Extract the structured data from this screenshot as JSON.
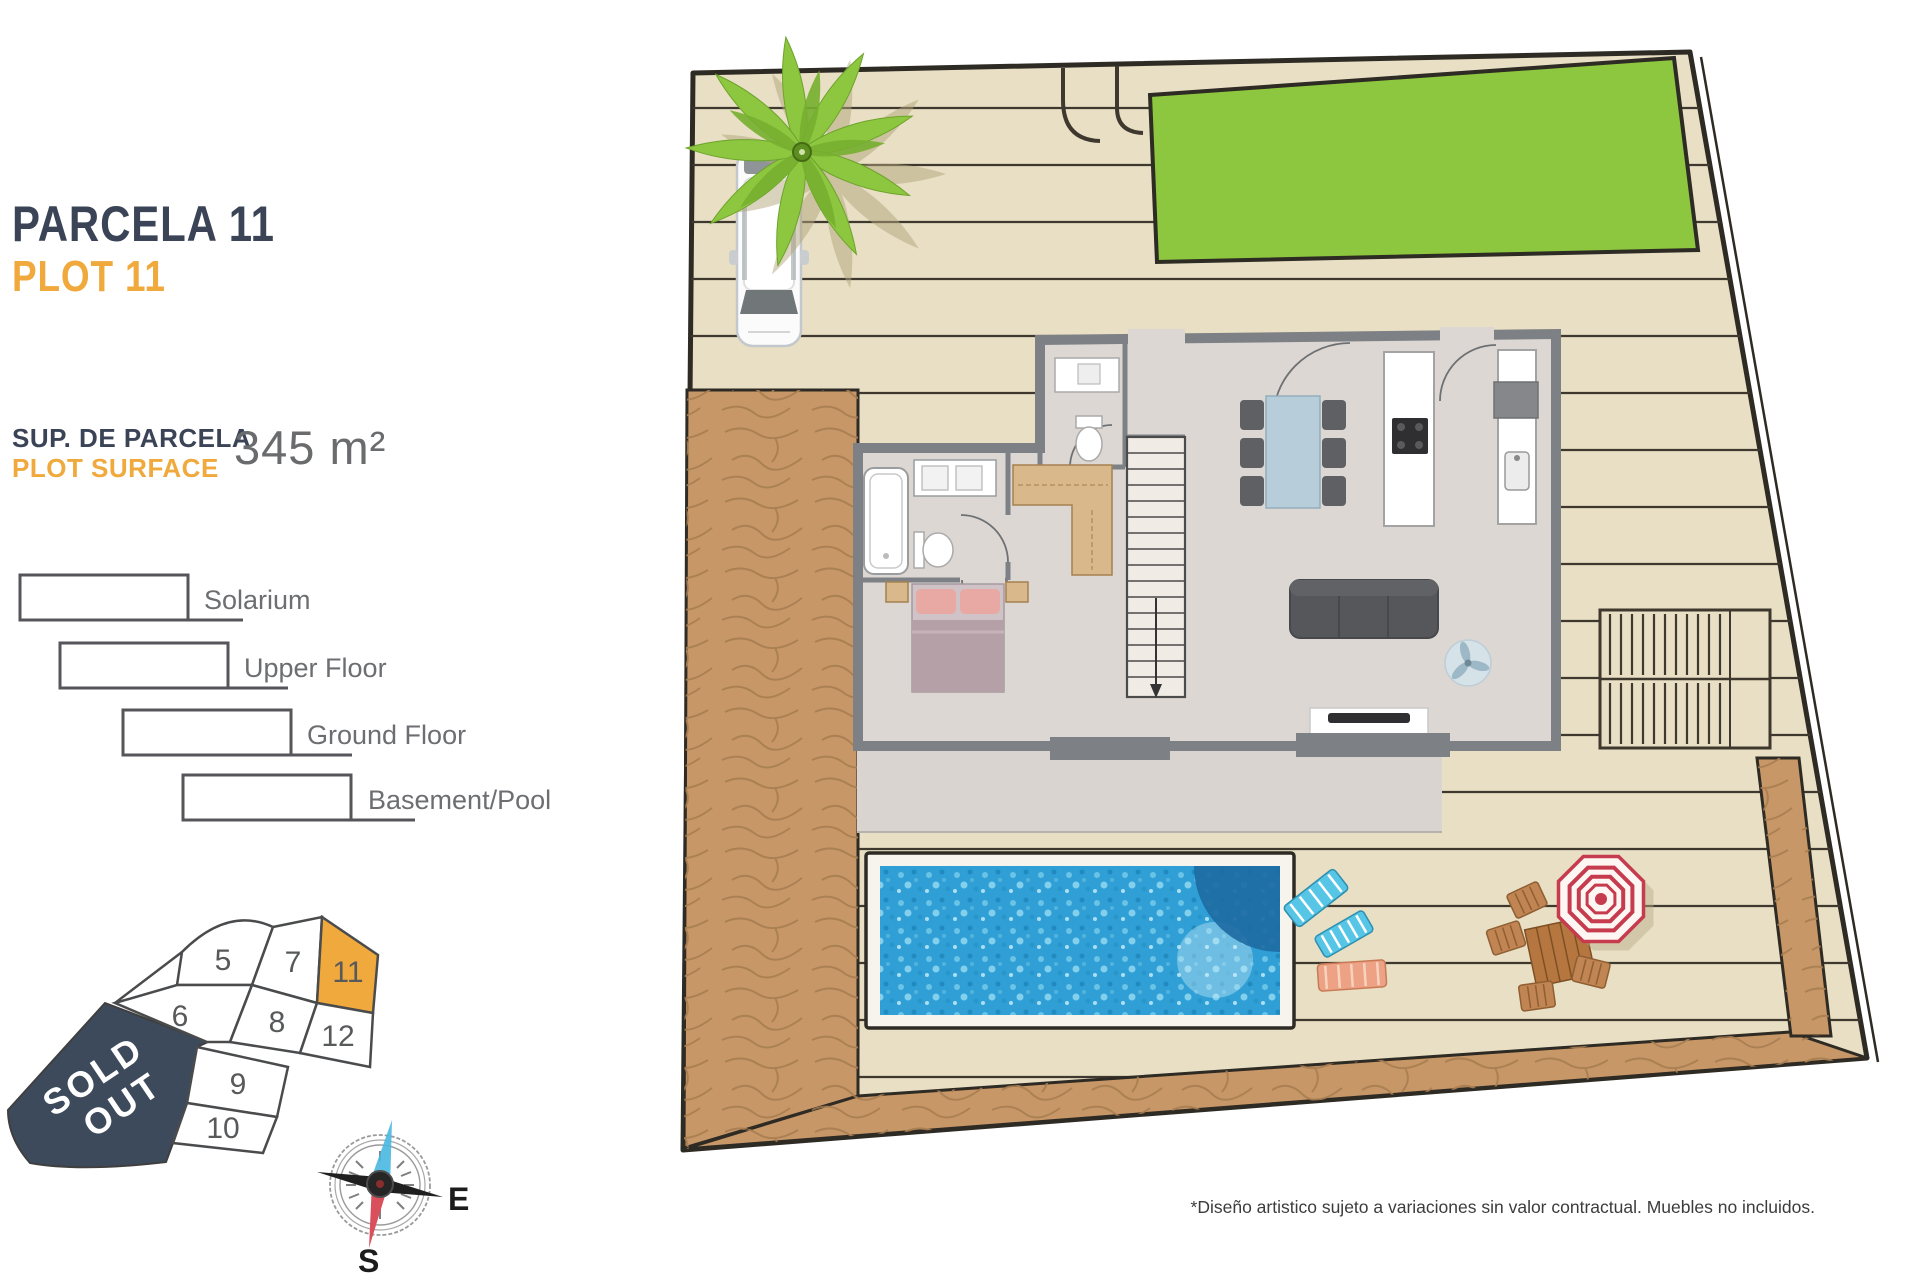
{
  "header": {
    "parcela": "PARCELA 11",
    "plot": "PLOT 11"
  },
  "surface": {
    "label_es": "SUP. DE PARCELA",
    "label_en": "PLOT SURFACE",
    "area": "345 m²"
  },
  "legend": {
    "items": [
      {
        "label": "Solarium"
      },
      {
        "label": "Upper Floor"
      },
      {
        "label": "Ground Floor"
      },
      {
        "label": "Basement/Pool"
      }
    ]
  },
  "plot_map": {
    "plots": [
      {
        "label": "5",
        "highlighted": false
      },
      {
        "label": "6",
        "highlighted": false
      },
      {
        "label": "7",
        "highlighted": false
      },
      {
        "label": "8",
        "highlighted": false
      },
      {
        "label": "9",
        "highlighted": false
      },
      {
        "label": "10",
        "highlighted": false
      },
      {
        "label": "11",
        "highlighted": true
      },
      {
        "label": "12",
        "highlighted": false
      }
    ],
    "sold_out": {
      "line1": "SOLD",
      "line2": "OUT"
    }
  },
  "compass": {
    "east": "E",
    "south": "S"
  },
  "footer": {
    "disclaimer": "*Diseño artistico sujeto a variaciones sin valor contractual. Muebles no incluidos."
  },
  "theme": {
    "navy": "#3B4457",
    "orange": "#F0A93C",
    "textgray": "#6D6E71",
    "soldnavy": "#3D4A5C",
    "grass": "#8DC63F",
    "deck": "#E8DFC4",
    "dirt": "#C79767",
    "dirtline": "#A87E52",
    "poolwater": "#2F9FD6",
    "pooldeep": "#1D6BA3",
    "wall": "#7D8084",
    "floorc": "#DCD7D3",
    "outline": "#2E2A24",
    "terrace": "#D9D4D0",
    "compassblue": "#49B8E0",
    "compassred": "#D9505C",
    "loungercyan": "#57C6E6",
    "loungersalmon": "#EDA285",
    "wood": "#B5773F",
    "umbrellared": "#C63B4D"
  }
}
